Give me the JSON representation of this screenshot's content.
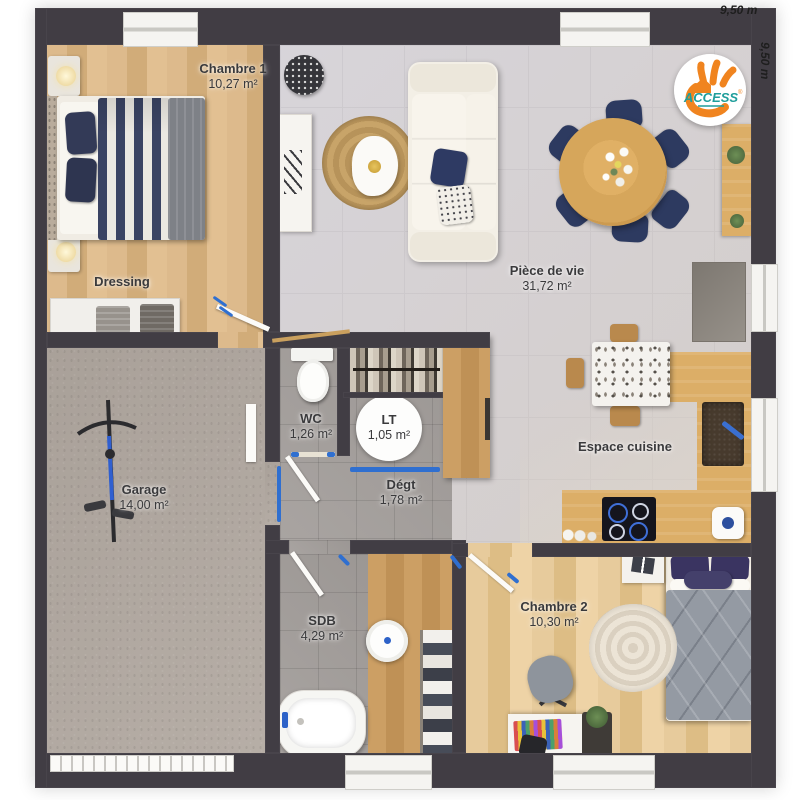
{
  "dimensions": {
    "top": "9,50 m",
    "right": "9,50 m"
  },
  "logo": {
    "brand": "ACCESS",
    "registered": "®"
  },
  "rooms": {
    "chambre1": {
      "name": "Chambre 1",
      "area": "10,27 m²"
    },
    "dressing": {
      "name": "Dressing",
      "area": ""
    },
    "piece_de_vie": {
      "name": "Pièce de vie",
      "area": "31,72 m²"
    },
    "wc": {
      "name": "WC",
      "area": "1,26 m²"
    },
    "lt": {
      "name": "LT",
      "area": "1,05 m²"
    },
    "degt": {
      "name": "Dégt",
      "area": "1,78 m²"
    },
    "garage": {
      "name": "Garage",
      "area": "14,00 m²"
    },
    "espace_cuisine": {
      "name": "Espace cuisine",
      "area": ""
    },
    "sdb": {
      "name": "SDB",
      "area": "4,29 m²"
    },
    "chambre2": {
      "name": "Chambre 2",
      "area": "10,30 m²"
    }
  },
  "colors": {
    "wall": "#413d44",
    "accent_blue": "#2f6fd0",
    "logo_orange": "#f0841f",
    "logo_teal": "#1f9e9b",
    "navy": "#2d3a60"
  }
}
